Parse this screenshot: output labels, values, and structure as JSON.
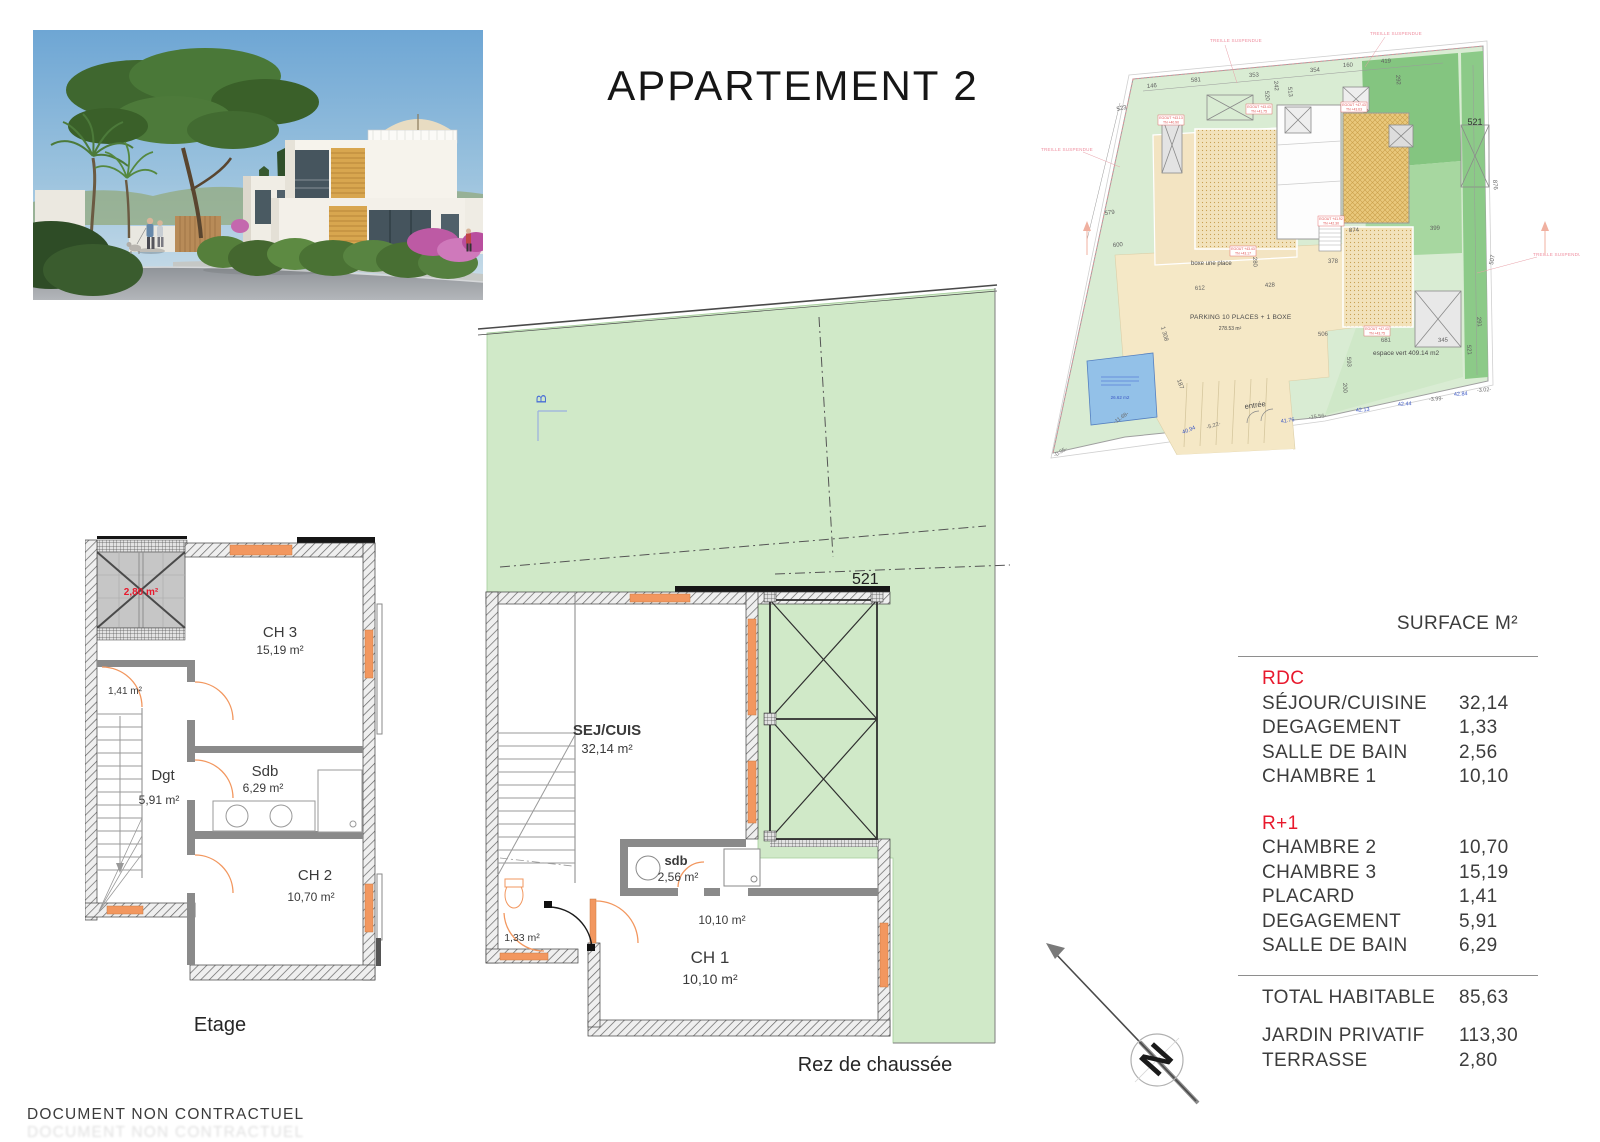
{
  "page": {
    "title": "APPARTEMENT 2",
    "footer": "DOCUMENT NON CONTRACTUEL"
  },
  "surface_table": {
    "header": "SURFACE M²",
    "sections": [
      {
        "name": "RDC",
        "rows": [
          {
            "label": "SÉJOUR/CUISINE",
            "value": "32,14"
          },
          {
            "label": "DEGAGEMENT",
            "value": "1,33"
          },
          {
            "label": "SALLE DE BAIN",
            "value": "2,56"
          },
          {
            "label": "CHAMBRE 1",
            "value": "10,10"
          }
        ]
      },
      {
        "name": "R+1",
        "rows": [
          {
            "label": "CHAMBRE 2",
            "value": "10,70"
          },
          {
            "label": "CHAMBRE 3",
            "value": "15,19"
          },
          {
            "label": "PLACARD",
            "value": "1,41"
          },
          {
            "label": "DEGAGEMENT",
            "value": "5,91"
          },
          {
            "label": "SALLE DE BAIN",
            "value": "6,29"
          }
        ]
      }
    ],
    "total": {
      "label": "TOTAL HABITABLE",
      "value": "85,63"
    },
    "extras": [
      {
        "label": "JARDIN PRIVATIF",
        "value": "113,30"
      },
      {
        "label": "TERRASSE",
        "value": "2,80"
      }
    ],
    "accent_color": "#e8192d"
  },
  "ground_floor": {
    "caption": "Rez de chaussée",
    "parcel": "521",
    "section_mark": "B",
    "sej": {
      "name": "SEJ/CUIS",
      "area": "32,14 m²"
    },
    "sdb": {
      "name": "sdb",
      "area": "2,56 m²"
    },
    "wc_area": "1,33 m²",
    "ch1": {
      "name": "CH 1",
      "area": "10,10 m²",
      "area_small": "10,10 m²"
    }
  },
  "upper_floor": {
    "caption": "Etage",
    "terrace_area": "2,80 m²",
    "placard_area": "1,41 m²",
    "ch3": {
      "name": "CH 3",
      "area": "15,19 m²"
    },
    "sdb": {
      "name": "Sdb",
      "area": "6,29 m²"
    },
    "dgt": {
      "name": "Dgt",
      "area": "5,91 m²"
    },
    "ch2": {
      "name": "CH 2",
      "area": "10,70 m²"
    }
  },
  "site_plan": {
    "parcel_number": "521",
    "boxe_label": "boxe une place",
    "parking_label": "PARKING 10 PLACES + 1 BOXE",
    "parking_area": "278.53 m²",
    "espace_vert": "espace vert 409.14 m2",
    "entree": "entrée",
    "pool_area": "26.62 m2",
    "treille": "TREILLE SUSPENDUE",
    "dims": [
      "523",
      "600",
      "579",
      "146",
      "581",
      "353",
      "242",
      "354",
      "160",
      "419",
      "520",
      "513",
      "292",
      "612",
      "428",
      "378",
      "280",
      "506",
      "200",
      "593",
      "681",
      "345",
      "507",
      "291",
      "874",
      "521",
      "876",
      "399",
      "-11.68-",
      "1 308",
      "187"
    ],
    "road_measures": [
      "40.94",
      "-5.22-",
      "41.76",
      "-15.56-",
      "42.13",
      "42.44",
      "-3.99-",
      "42.84",
      "-3.02-",
      "-0.35-"
    ],
    "egout_notes": [
      {
        "a": "EGOUT +43.43",
        "b": "TN +41.75"
      },
      {
        "a": "EGOUT +47.43",
        "b": "TN +43.63"
      },
      {
        "a": "EGOUT +43.13",
        "b": "TN +40.90"
      },
      {
        "a": "EGOUT +41.92",
        "b": "TN +42.30"
      },
      {
        "a": "EGOUT +43.43",
        "b": "TN +43.17"
      },
      {
        "a": "EGOUT +47.43",
        "b": "TN +43.75"
      }
    ]
  },
  "compass": {
    "label": "N"
  }
}
